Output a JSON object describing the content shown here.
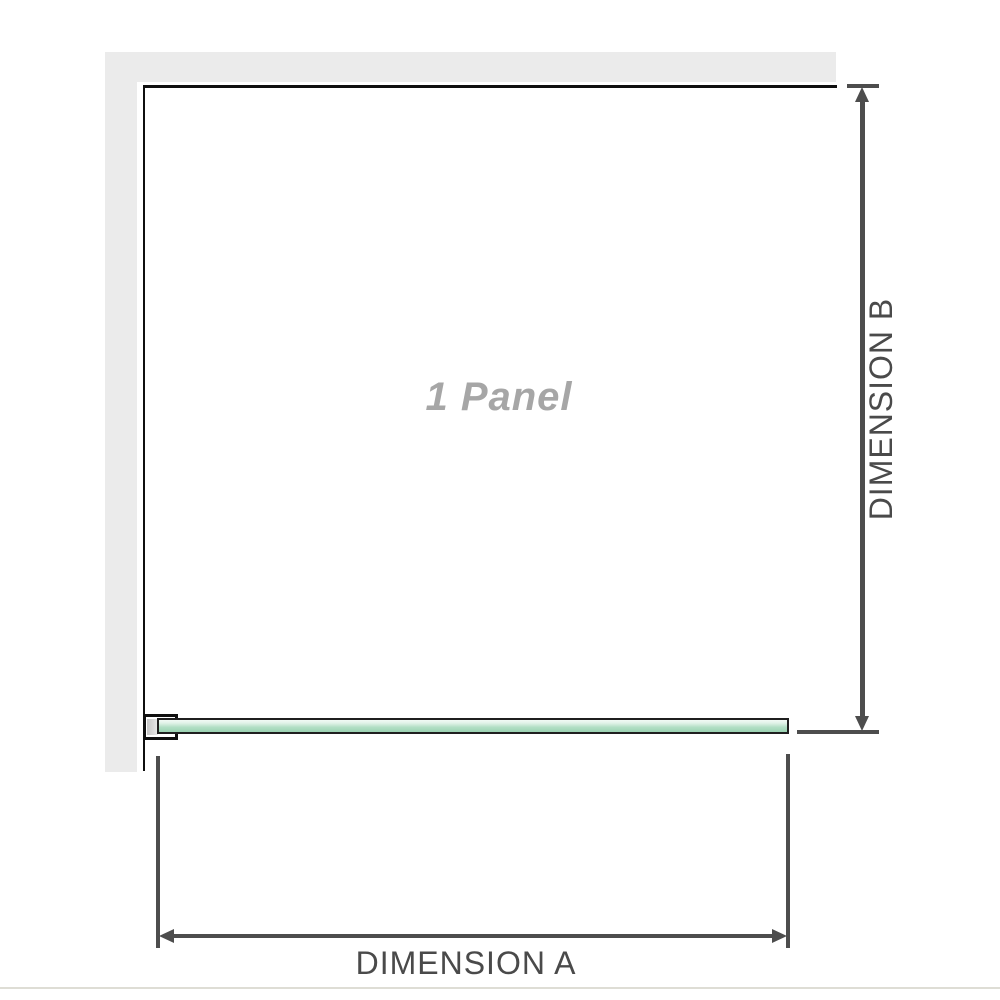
{
  "labels": {
    "panel": "1 Panel",
    "dimension_a": "DIMENSION A",
    "dimension_b": "DIMENSION B"
  },
  "icons": {
    "dim_b_arrowhead_top": "up-arrowhead",
    "dim_b_arrowhead_bottom": "down-arrowhead",
    "dim_a_arrowhead_left": "left-arrowhead",
    "dim_a_arrowhead_right": "right-arrowhead"
  },
  "colors": {
    "wall": "#ebebeb",
    "outline": "#0f0f0f",
    "dimension": "#4d4d4d",
    "label_text": "#4a4a4a",
    "panel_text": "#a6a6a6",
    "glass_border": "#1f1f1f",
    "glass_fill_light": "#f2faf5",
    "glass_fill_mid": "#b2dfc5",
    "glass_fill_dark": "#9bd2b2",
    "baseline": "#deddd5"
  }
}
